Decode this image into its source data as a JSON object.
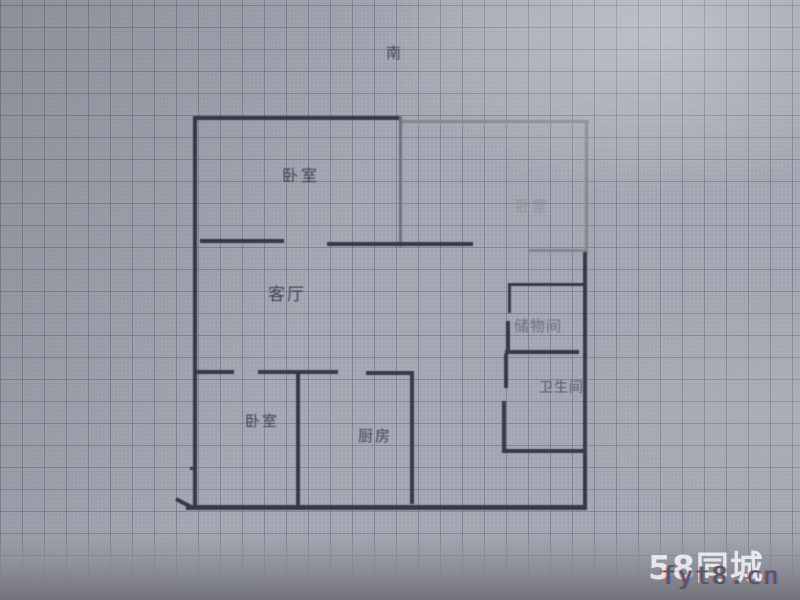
{
  "floor_plan": {
    "compass_label": "南",
    "rooms": [
      {
        "id": "bedroom-top-left",
        "label": "卧室"
      },
      {
        "id": "bedroom-right",
        "label": "卧室"
      },
      {
        "id": "living-room",
        "label": "客厅"
      },
      {
        "id": "storage-room",
        "label": "储物间"
      },
      {
        "id": "bathroom",
        "label": "卫生间"
      },
      {
        "id": "bedroom-bottom-left",
        "label": "卧室"
      },
      {
        "id": "kitchen",
        "label": "厨房"
      }
    ],
    "wall_colors": {
      "dark": "#333a4a",
      "light": "#82878f",
      "medium": "#6d7380"
    }
  },
  "watermark": {
    "site_logo": "58同城",
    "overlay_text": "fyt8.cn"
  }
}
